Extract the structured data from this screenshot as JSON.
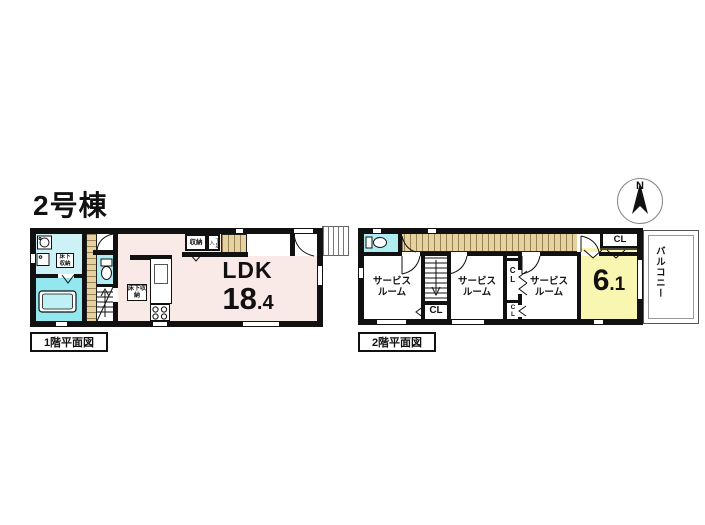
{
  "title": "2号棟",
  "compass": {
    "north": "N"
  },
  "floor1": {
    "caption": "1階平面図",
    "ldk_label": "LDK",
    "ldk_area_int": "18",
    "ldk_area_dec": ".4",
    "storage_label": "収納",
    "shoe_storage_label": "下足入",
    "underfloor_storage_1": "床下収納",
    "underfloor_storage_2": "床下収納"
  },
  "floor2": {
    "caption": "2階平面図",
    "service_room_1": "サービスルーム",
    "service_room_2": "サービスルーム",
    "service_room_3": "サービスルーム",
    "room_area_int": "6",
    "room_area_dec": ".1",
    "balcony_label": "バルコニー",
    "closet_top": "CL",
    "closet_stairs": "CL",
    "closet_mid": "CL",
    "closet_small": "CL"
  },
  "colors": {
    "wall": "#111111",
    "ldk_pink": "#faeae7",
    "washroom_cyan": "#ccf1f6",
    "bath_cyan": "#93e7ef",
    "toilet_cyan": "#aeeef3",
    "wood_tan": "#e6d29e",
    "room_yellow": "#f8f6b0"
  }
}
